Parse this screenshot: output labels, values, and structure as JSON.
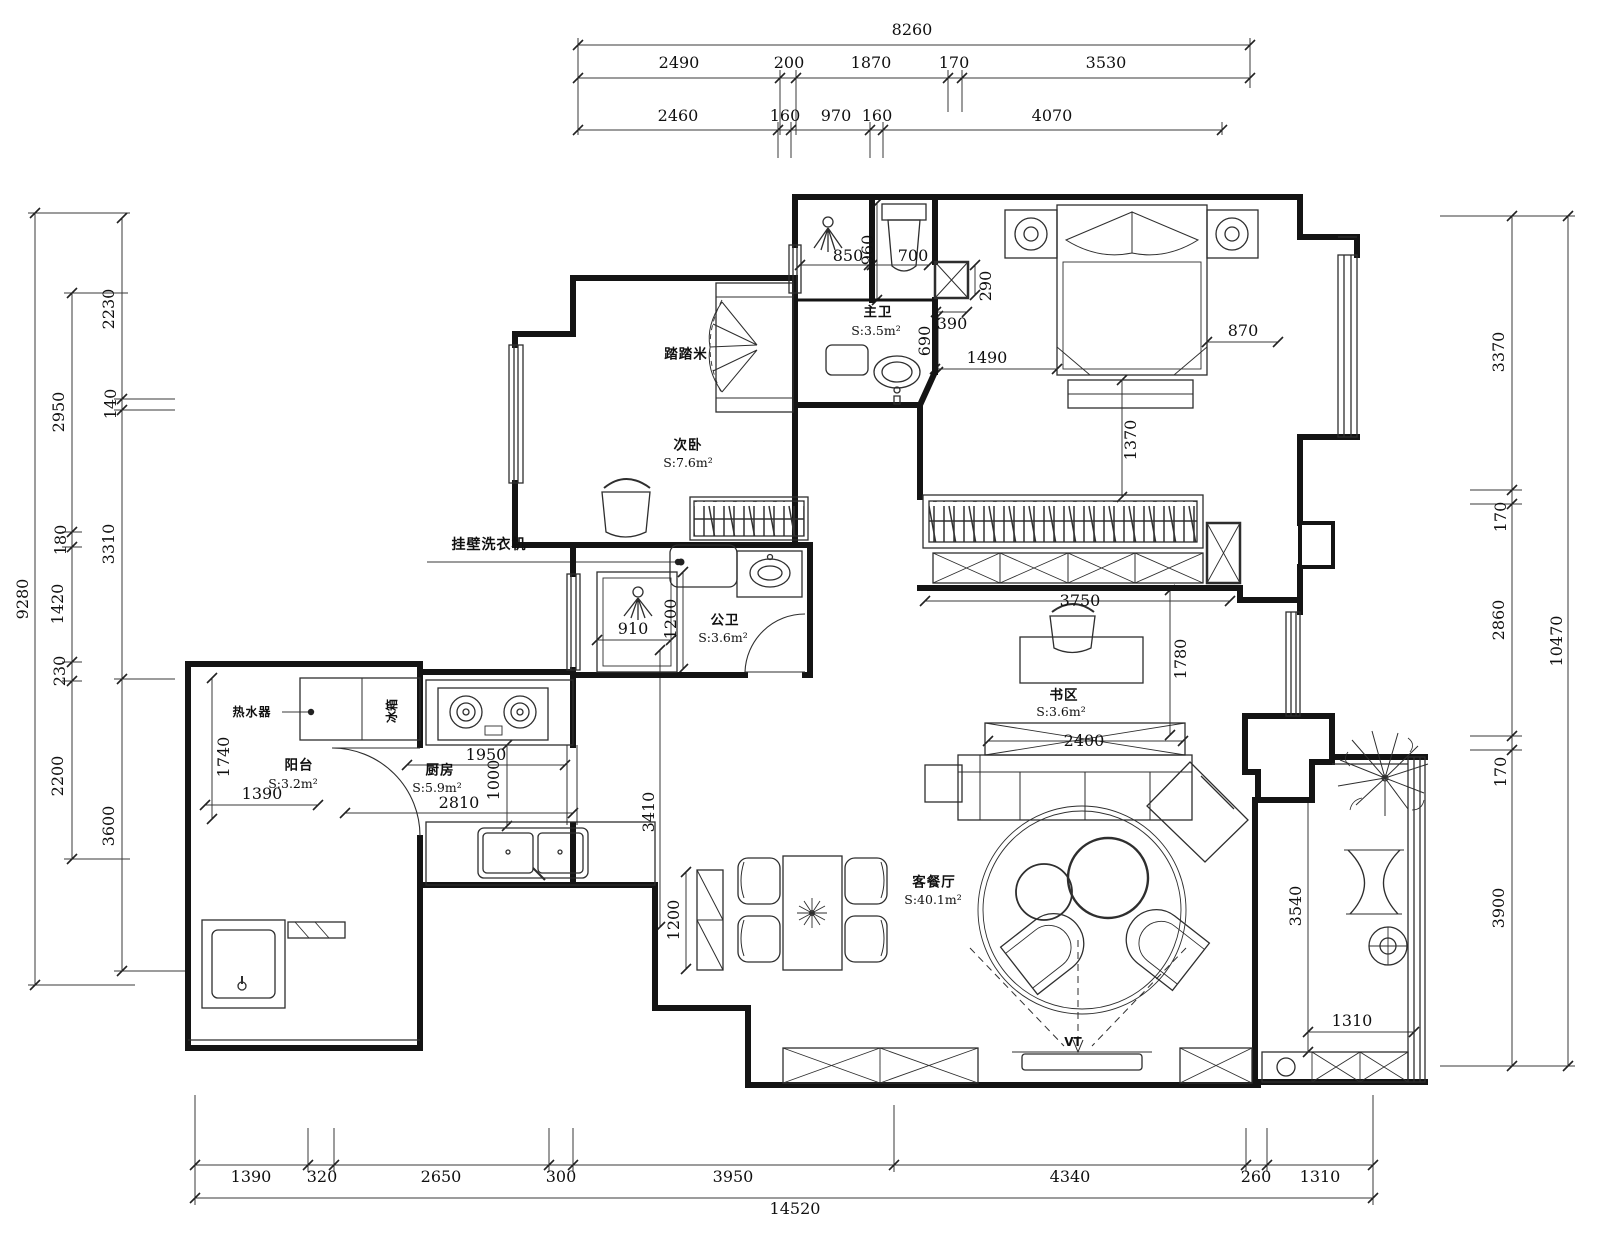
{
  "drawing": {
    "kind": "apartment-floor-plan",
    "unit": "mm"
  },
  "colors": {
    "wall": "#141414",
    "thin": "#2e2e2e",
    "dim": "#3a3a3a",
    "bg": "#ffffff"
  },
  "rooms": [
    {
      "name": "tatami",
      "label": "踏踏米",
      "area": ""
    },
    {
      "name": "second-bedroom",
      "label": "次卧",
      "area": "S:7.6m²"
    },
    {
      "name": "master-bath",
      "label": "主卫",
      "area": "S:3.5m²"
    },
    {
      "name": "public-bath",
      "label": "公卫",
      "area": "S:3.6m²"
    },
    {
      "name": "balcony-left",
      "label": "阳台",
      "area": "S:3.2m²"
    },
    {
      "name": "kitchen",
      "label": "厨房",
      "area": "S:5.9m²"
    },
    {
      "name": "study",
      "label": "书区",
      "area": "S:3.6m²"
    },
    {
      "name": "living-dining",
      "label": "客餐厅",
      "area": "S:40.1m²"
    }
  ],
  "labels": [
    {
      "name": "dim-top-total",
      "text": "8260",
      "x": 912,
      "y": 30,
      "cls": "dim"
    },
    {
      "name": "dim-top-2490",
      "text": "2490",
      "x": 679,
      "y": 63,
      "cls": "dim"
    },
    {
      "name": "dim-top-200",
      "text": "200",
      "x": 789,
      "y": 63,
      "cls": "dim"
    },
    {
      "name": "dim-top-1870",
      "text": "1870",
      "x": 871,
      "y": 63,
      "cls": "dim"
    },
    {
      "name": "dim-top-170",
      "text": "170",
      "x": 954,
      "y": 63,
      "cls": "dim"
    },
    {
      "name": "dim-top-3530",
      "text": "3530",
      "x": 1106,
      "y": 63,
      "cls": "dim"
    },
    {
      "name": "dim-top-2460",
      "text": "2460",
      "x": 678,
      "y": 116,
      "cls": "dim"
    },
    {
      "name": "dim-top-160a",
      "text": "160",
      "x": 785,
      "y": 116,
      "cls": "dim"
    },
    {
      "name": "dim-top-970",
      "text": "970",
      "x": 836,
      "y": 116,
      "cls": "dim"
    },
    {
      "name": "dim-top-160b",
      "text": "160",
      "x": 877,
      "y": 116,
      "cls": "dim"
    },
    {
      "name": "dim-top-4070",
      "text": "4070",
      "x": 1052,
      "y": 116,
      "cls": "dim"
    },
    {
      "name": "dim-left-total",
      "text": "9280",
      "x": 23,
      "y": 599,
      "rot": 1,
      "cls": "dim"
    },
    {
      "name": "dim-left-2950",
      "text": "2950",
      "x": 59,
      "y": 412,
      "rot": 1,
      "cls": "dim"
    },
    {
      "name": "dim-left-180",
      "text": "180",
      "x": 61,
      "y": 540,
      "rot": 1,
      "cls": "dim"
    },
    {
      "name": "dim-left-1420",
      "text": "1420",
      "x": 58,
      "y": 604,
      "rot": 1,
      "cls": "dim"
    },
    {
      "name": "dim-left-230",
      "text": "230",
      "x": 60,
      "y": 671,
      "rot": 1,
      "cls": "dim"
    },
    {
      "name": "dim-left-2200",
      "text": "2200",
      "x": 58,
      "y": 776,
      "rot": 1,
      "cls": "dim"
    },
    {
      "name": "dim-left-2230",
      "text": "2230",
      "x": 109,
      "y": 309,
      "rot": 1,
      "cls": "dim"
    },
    {
      "name": "dim-left-140",
      "text": "140",
      "x": 111,
      "y": 404,
      "rot": 1,
      "cls": "dim"
    },
    {
      "name": "dim-left-3310",
      "text": "3310",
      "x": 109,
      "y": 544,
      "rot": 1,
      "cls": "dim"
    },
    {
      "name": "dim-left-3600",
      "text": "3600",
      "x": 109,
      "y": 826,
      "rot": 1,
      "cls": "dim"
    },
    {
      "name": "dim-right-3370",
      "text": "3370",
      "x": 1499,
      "y": 352,
      "rot": 1,
      "cls": "dim"
    },
    {
      "name": "dim-right-170a",
      "text": "170",
      "x": 1501,
      "y": 517,
      "rot": 1,
      "cls": "dim"
    },
    {
      "name": "dim-right-2860",
      "text": "2860",
      "x": 1499,
      "y": 620,
      "rot": 1,
      "cls": "dim"
    },
    {
      "name": "dim-right-170b",
      "text": "170",
      "x": 1501,
      "y": 772,
      "rot": 1,
      "cls": "dim"
    },
    {
      "name": "dim-right-3900",
      "text": "3900",
      "x": 1499,
      "y": 908,
      "rot": 1,
      "cls": "dim"
    },
    {
      "name": "dim-right-total",
      "text": "10470",
      "x": 1557,
      "y": 641,
      "rot": 1,
      "cls": "dim"
    },
    {
      "name": "dim-bot-1390",
      "text": "1390",
      "x": 251,
      "y": 1177,
      "cls": "dim"
    },
    {
      "name": "dim-bot-320",
      "text": "320",
      "x": 322,
      "y": 1177,
      "cls": "dim"
    },
    {
      "name": "dim-bot-2650",
      "text": "2650",
      "x": 441,
      "y": 1177,
      "cls": "dim"
    },
    {
      "name": "dim-bot-300",
      "text": "300",
      "x": 561,
      "y": 1177,
      "cls": "dim"
    },
    {
      "name": "dim-bot-3950",
      "text": "3950",
      "x": 733,
      "y": 1177,
      "cls": "dim"
    },
    {
      "name": "dim-bot-4340",
      "text": "4340",
      "x": 1070,
      "y": 1177,
      "cls": "dim"
    },
    {
      "name": "dim-bot-260",
      "text": "260",
      "x": 1256,
      "y": 1177,
      "cls": "dim"
    },
    {
      "name": "dim-bot-1310",
      "text": "1310",
      "x": 1320,
      "y": 1177,
      "cls": "dim"
    },
    {
      "name": "dim-bot-total",
      "text": "14520",
      "x": 795,
      "y": 1209,
      "cls": "dim"
    },
    {
      "name": "dim-in-850",
      "text": "850",
      "x": 848,
      "y": 256,
      "cls": "dim"
    },
    {
      "name": "dim-in-960",
      "text": "960",
      "x": 868,
      "y": 250,
      "rot": 1,
      "cls": "dim"
    },
    {
      "name": "dim-in-700",
      "text": "700",
      "x": 913,
      "y": 256,
      "cls": "dim"
    },
    {
      "name": "dim-in-290",
      "text": "290",
      "x": 986,
      "y": 286,
      "rot": 1,
      "cls": "dim"
    },
    {
      "name": "dim-in-390",
      "text": "390",
      "x": 952,
      "y": 324,
      "cls": "dim"
    },
    {
      "name": "dim-in-690",
      "text": "690",
      "x": 925,
      "y": 341,
      "rot": 1,
      "cls": "dim"
    },
    {
      "name": "dim-in-1490",
      "text": "1490",
      "x": 987,
      "y": 358,
      "cls": "dim"
    },
    {
      "name": "dim-in-870",
      "text": "870",
      "x": 1243,
      "y": 331,
      "cls": "dim"
    },
    {
      "name": "dim-in-1370",
      "text": "1370",
      "x": 1131,
      "y": 440,
      "rot": 1,
      "cls": "dim"
    },
    {
      "name": "dim-in-910",
      "text": "910",
      "x": 633,
      "y": 629,
      "cls": "dim"
    },
    {
      "name": "dim-in-1200-shower",
      "text": "1200",
      "x": 671,
      "y": 619,
      "rot": 1,
      "cls": "dim"
    },
    {
      "name": "dim-in-3750",
      "text": "3750",
      "x": 1080,
      "y": 601,
      "cls": "dim"
    },
    {
      "name": "dim-in-1780",
      "text": "1780",
      "x": 1181,
      "y": 659,
      "rot": 1,
      "cls": "dim"
    },
    {
      "name": "dim-in-2400",
      "text": "2400",
      "x": 1084,
      "y": 741,
      "cls": "dim"
    },
    {
      "name": "dim-in-1740",
      "text": "1740",
      "x": 224,
      "y": 757,
      "rot": 1,
      "cls": "dim"
    },
    {
      "name": "dim-in-1390b",
      "text": "1390",
      "x": 262,
      "y": 794,
      "cls": "dim"
    },
    {
      "name": "dim-in-1950",
      "text": "1950",
      "x": 486,
      "y": 755,
      "cls": "dim"
    },
    {
      "name": "dim-in-1000",
      "text": "1000",
      "x": 494,
      "y": 780,
      "rot": 1,
      "cls": "dim"
    },
    {
      "name": "dim-in-2810",
      "text": "2810",
      "x": 459,
      "y": 803,
      "cls": "dim"
    },
    {
      "name": "dim-in-3410",
      "text": "3410",
      "x": 649,
      "y": 812,
      "rot": 1,
      "cls": "dim"
    },
    {
      "name": "dim-in-1200-cab",
      "text": "1200",
      "x": 674,
      "y": 920,
      "rot": 1,
      "cls": "dim"
    },
    {
      "name": "dim-in-3540",
      "text": "3540",
      "x": 1296,
      "y": 906,
      "rot": 1,
      "cls": "dim"
    },
    {
      "name": "dim-in-1310b",
      "text": "1310",
      "x": 1352,
      "y": 1021,
      "cls": "dim"
    },
    {
      "name": "room-tatami",
      "text": "踏踏米",
      "x": 686,
      "y": 355,
      "cls": "room"
    },
    {
      "name": "room-second-bedroom",
      "text": "次卧",
      "x": 688,
      "y": 446,
      "cls": "room"
    },
    {
      "name": "room-second-bedroom-area",
      "text": "S:7.6m²",
      "x": 688,
      "y": 463,
      "cls": "area"
    },
    {
      "name": "room-master-bath",
      "text": "主卫",
      "x": 878,
      "y": 313,
      "cls": "room"
    },
    {
      "name": "room-master-bath-area",
      "text": "S:3.5m²",
      "x": 876,
      "y": 331,
      "cls": "area"
    },
    {
      "name": "room-public-bath",
      "text": "公卫",
      "x": 725,
      "y": 621,
      "cls": "room"
    },
    {
      "name": "room-public-bath-area",
      "text": "S:3.6m²",
      "x": 723,
      "y": 638,
      "cls": "area"
    },
    {
      "name": "room-balcony",
      "text": "阳台",
      "x": 299,
      "y": 766,
      "cls": "room"
    },
    {
      "name": "room-balcony-area",
      "text": "S:3.2m²",
      "x": 293,
      "y": 784,
      "cls": "area"
    },
    {
      "name": "room-kitchen",
      "text": "厨房",
      "x": 440,
      "y": 771,
      "cls": "room"
    },
    {
      "name": "room-kitchen-area",
      "text": "S:5.9m²",
      "x": 437,
      "y": 788,
      "cls": "area"
    },
    {
      "name": "room-study",
      "text": "书区",
      "x": 1064,
      "y": 696,
      "cls": "room"
    },
    {
      "name": "room-study-area",
      "text": "S:3.6m²",
      "x": 1061,
      "y": 712,
      "cls": "area"
    },
    {
      "name": "room-living",
      "text": "客餐厅",
      "x": 934,
      "y": 883,
      "cls": "room"
    },
    {
      "name": "room-living-area",
      "text": "S:40.1m²",
      "x": 933,
      "y": 900,
      "cls": "area"
    },
    {
      "name": "note-wall-washer",
      "text": "挂壁洗衣机",
      "x": 489,
      "y": 545,
      "cls": "ann"
    },
    {
      "name": "note-water-heater",
      "text": "热水器",
      "x": 252,
      "y": 712,
      "cls": "ann sm"
    },
    {
      "name": "note-fridge",
      "text": "冰箱",
      "x": 392,
      "y": 711,
      "rot": 1,
      "cls": "sm"
    },
    {
      "name": "note-tv",
      "text": "VT",
      "x": 1073,
      "y": 1042,
      "cls": "sm"
    }
  ]
}
